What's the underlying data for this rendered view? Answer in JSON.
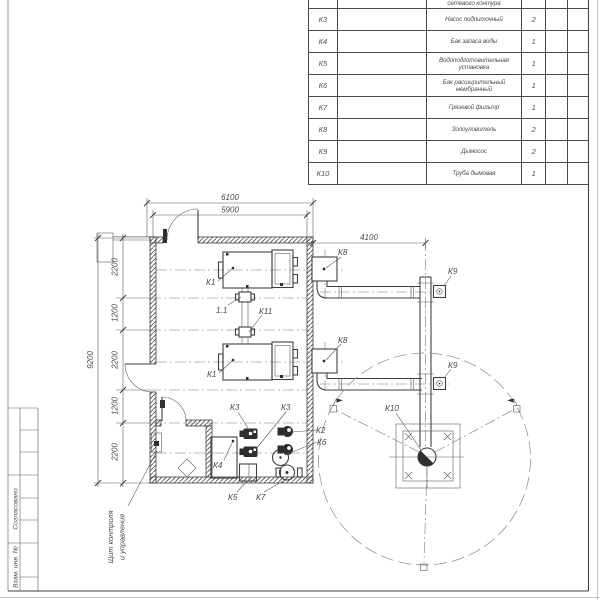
{
  "colors": {
    "ink": "#3f3f3f",
    "paper": "#ffffff"
  },
  "table": {
    "rows": [
      {
        "pos": "К2",
        "name": "сетевого контура",
        "qty": "2"
      },
      {
        "pos": "К3",
        "name": "Насос подпиточный",
        "qty": "2"
      },
      {
        "pos": "К4",
        "name": "Бак запаса воды",
        "qty": "1"
      },
      {
        "pos": "К5",
        "name": "Водоподготовительная установка",
        "qty": "1"
      },
      {
        "pos": "К6",
        "name": "Бак расширительный мембранный",
        "qty": "1"
      },
      {
        "pos": "К7",
        "name": "Грязевой фильтр",
        "qty": "1"
      },
      {
        "pos": "К8",
        "name": "Золоуловитель",
        "qty": "2"
      },
      {
        "pos": "К9",
        "name": "Дымосос",
        "qty": "2"
      },
      {
        "pos": "К10",
        "name": "Труба дымовая",
        "qty": "1"
      }
    ]
  },
  "frame": {
    "approve": "Согласовано",
    "inv": "Взам. инв. №"
  },
  "plan": {
    "dims": {
      "w_outer": "6100",
      "w_inner": "5900",
      "flue": "4100",
      "h_outer": "9200",
      "chain": [
        "2200",
        "1200",
        "2200",
        "1200",
        "2200"
      ]
    },
    "labels": {
      "k1_top": "К1",
      "k1_bottom": "К1",
      "v11": "1.1",
      "k11": "К11",
      "k8_top": "К8",
      "k8_bottom": "К8",
      "k9_top": "К9",
      "k9_bottom": "К9",
      "k10": "К10",
      "k2": "К2",
      "k3_left": "К3",
      "k3_right": "К3",
      "k4": "К4",
      "k5": "К5",
      "k6": "К6",
      "k7": "К7"
    },
    "callout": {
      "line1": "Щит контроля",
      "line2": "и управления"
    }
  }
}
